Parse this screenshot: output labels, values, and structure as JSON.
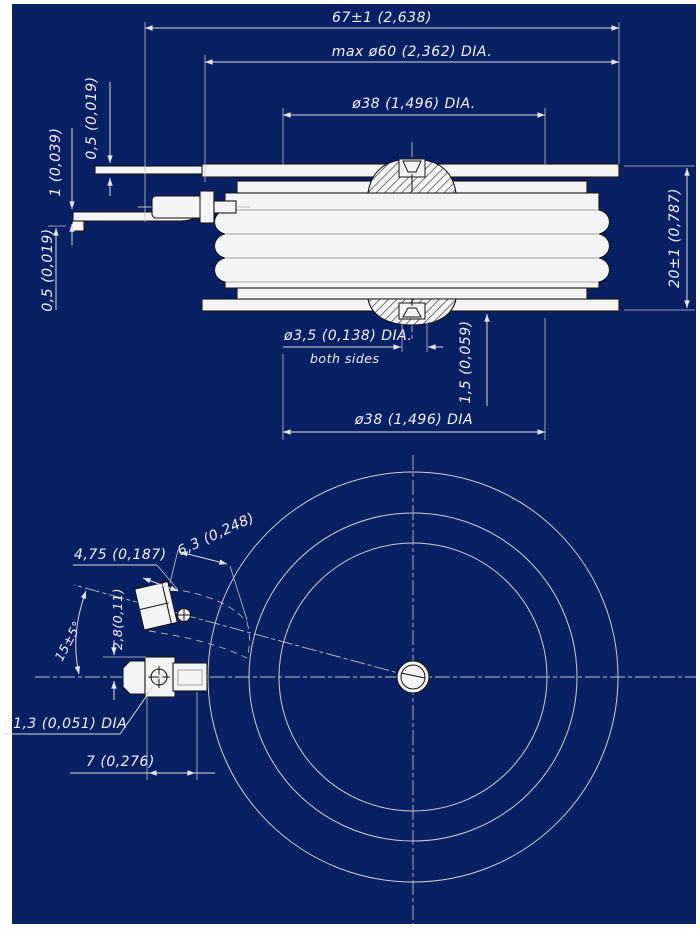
{
  "drawing_type": "technical-dimension-drawing",
  "colors": {
    "sheet_background": "#0a2064",
    "line": "#d9d9d9",
    "text": "#f2f2f2",
    "part_fill": "#f4f4f4"
  },
  "side_view": {
    "dim_overall_width": "67±1 (2,638)",
    "dim_max_diameter": "max ø60 (2,362) DIA.",
    "dim_pole_face_top": "ø38 (1,496) DIA.",
    "dim_lead_thickness_top": "0,5 (0,019)",
    "dim_gate_lead_thickness": "1 (0,039)",
    "dim_lead_thickness_bottom": "0,5 (0,019)",
    "dim_height": "20±1 (0,787)",
    "dim_center_hole": "ø3,5 (0,138) DIA.",
    "dim_center_hole_note": "both sides",
    "dim_recess_depth": "1,5 (0,059)",
    "dim_pole_face_bottom": "ø38 (1,496) DIA"
  },
  "bottom_view": {
    "dim_lug_width": "4,75 (0,187)",
    "dim_lug_length": "6,3 (0,248)",
    "dim_gate_angle": "15±5°",
    "dim_lug_offset": "2,8(0,11)",
    "dim_lug_hole": "ø1,3 (0,051) DIA",
    "dim_lug_end": "7 (0,276)"
  }
}
